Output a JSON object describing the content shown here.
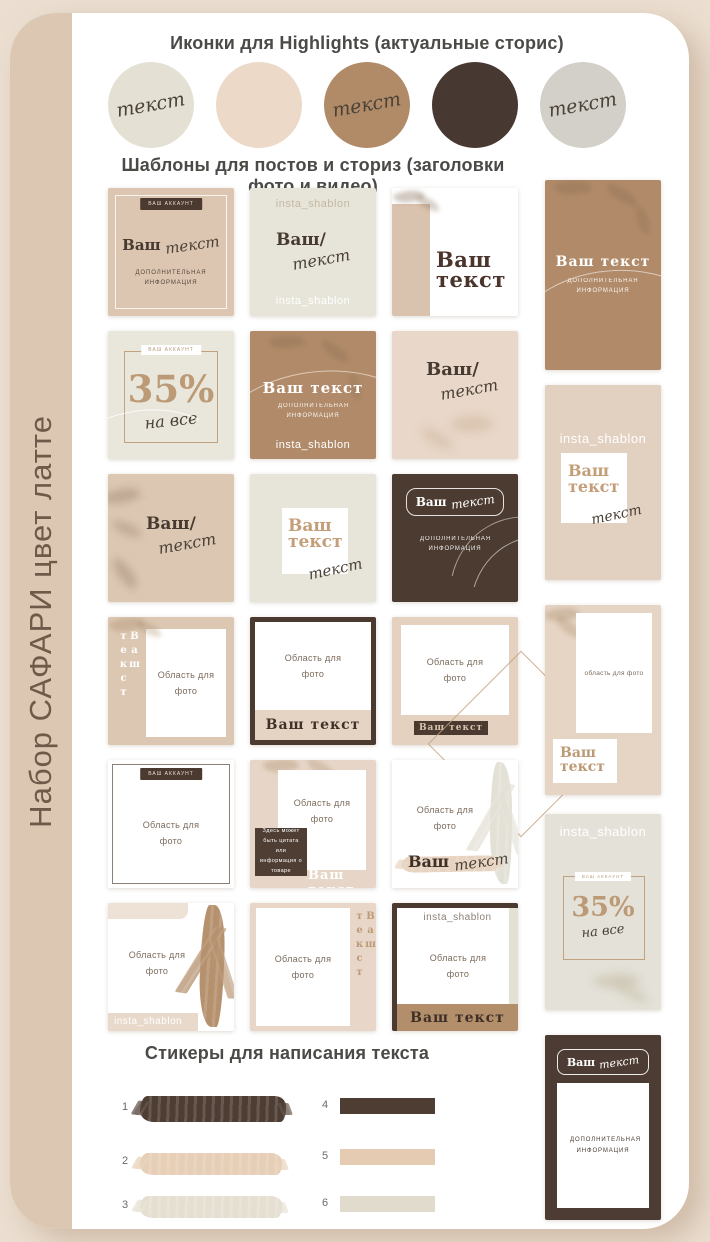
{
  "sidebar": {
    "label": "Набор САФАРИ цвет латте"
  },
  "highlights": {
    "title": "Иконки для Highlights (актуальные сторис)",
    "icons": [
      {
        "name": "icon-sage",
        "color": "#e4e1d4",
        "label": "текст"
      },
      {
        "name": "icon-cream",
        "color": "#ecd9c8",
        "label": ""
      },
      {
        "name": "icon-tan",
        "color": "#b18b68",
        "label": "текст"
      },
      {
        "name": "icon-brown",
        "color": "#473931",
        "label": ""
      },
      {
        "name": "icon-gray",
        "color": "#d3d0c9",
        "label": "текст"
      }
    ]
  },
  "templates": {
    "title": "Шаблоны для постов и сториз (заголовки фото и видео)"
  },
  "cards": {
    "r1c1": {
      "badge": "ВАШ АККАУНТ",
      "title": "Ваш",
      "script": "текст",
      "info": "ДОПОЛНИТЕЛЬНАЯ ИНФОРМАЦИЯ"
    },
    "r1c2": {
      "top": "insta_shablon",
      "title": "Ваш/",
      "script": "текст",
      "bottom": "insta_shablon"
    },
    "r1c3": {
      "line1": "Ваш",
      "line2": "текст"
    },
    "r2c1": {
      "badge": "ВАШ АККАУНТ",
      "percent": "35%",
      "script": "на все"
    },
    "r2c2": {
      "title": "Ваш текст",
      "info": "ДОПОЛНИТЕЛЬНАЯ ИНФОРМАЦИЯ",
      "bottom": "insta_shablon"
    },
    "r2c3": {
      "title": "Ваш/",
      "script": "текст"
    },
    "r3c1": {
      "title": "Ваш/",
      "script": "текст"
    },
    "r3c2": {
      "line1": "Ваш",
      "line2": "текст",
      "script": "текст"
    },
    "r3c3": {
      "title": "Ваш",
      "script": "текст",
      "info": "ДОПОЛНИТЕЛЬНАЯ ИНФОРМАЦИЯ"
    },
    "r4c1": {
      "vertical": "Ваш текст",
      "photo": "Область для фото"
    },
    "r4c2": {
      "photo": "Область для фото",
      "title": "Ваш текст"
    },
    "r4c3": {
      "photo": "Область для фото",
      "badge": "Ваш текст"
    },
    "r5c1": {
      "badge": "ВАШ АККАУНТ",
      "photo": "Область для фото"
    },
    "r5c2": {
      "photo": "Область для фото",
      "quote": "Здесь может быть цитата или информация о товаре",
      "title": "Ваш текст"
    },
    "r5c3": {
      "photo": "Область для фото",
      "title": "Ваш",
      "script": "текст"
    },
    "r6c1": {
      "photo": "Область для фото",
      "handle": "insta_shablon"
    },
    "r6c2": {
      "photo": "Область для фото",
      "vertical": "Ваш текст"
    },
    "r6c3": {
      "handle": "insta_shablon",
      "photo": "Область для фото",
      "title": "Ваш текст"
    }
  },
  "stories": {
    "s1": {
      "title": "Ваш текст",
      "info": "ДОПОЛНИТЕЛЬНАЯ ИНФОРМАЦИЯ"
    },
    "s2": {
      "handle": "insta_shablon",
      "line1": "Ваш",
      "line2": "текст",
      "script": "текст"
    },
    "s3": {
      "photo": "область для фото",
      "line1": "Ваш",
      "line2": "текст"
    },
    "s4": {
      "handle": "insta_shablon",
      "badge": "ВАШ АККАУНТ",
      "percent": "35%",
      "script": "на все"
    },
    "s5": {
      "title": "Ваш",
      "script": "текст",
      "info": "ДОПОЛНИТЕЛЬНАЯ ИНФОРМАЦИЯ"
    }
  },
  "stickers": {
    "title": "Стикеры для написания текста",
    "items": [
      {
        "num": "1",
        "color": "#4e3d33",
        "style": "brush"
      },
      {
        "num": "2",
        "color": "#e6cfb6",
        "style": "brush"
      },
      {
        "num": "3",
        "color": "#e5dfd2",
        "style": "brush"
      },
      {
        "num": "4",
        "color": "#4e3d33",
        "style": "rect"
      },
      {
        "num": "5",
        "color": "#e4cbb1",
        "style": "rect"
      },
      {
        "num": "6",
        "color": "#e1dbce",
        "style": "rect"
      }
    ]
  },
  "palette": {
    "background": "#ecdfd1",
    "sidebar_strip": "#dcc7b2",
    "beige_card": "#dcc6b2",
    "cream_card": "#e7e5da",
    "tan_card": "#b18b69",
    "dark_brown_card": "#4b3b31",
    "blush_card": "#e9d7c9",
    "accent_serif": "#bd9a76",
    "heading_text": "#4b4a47"
  }
}
